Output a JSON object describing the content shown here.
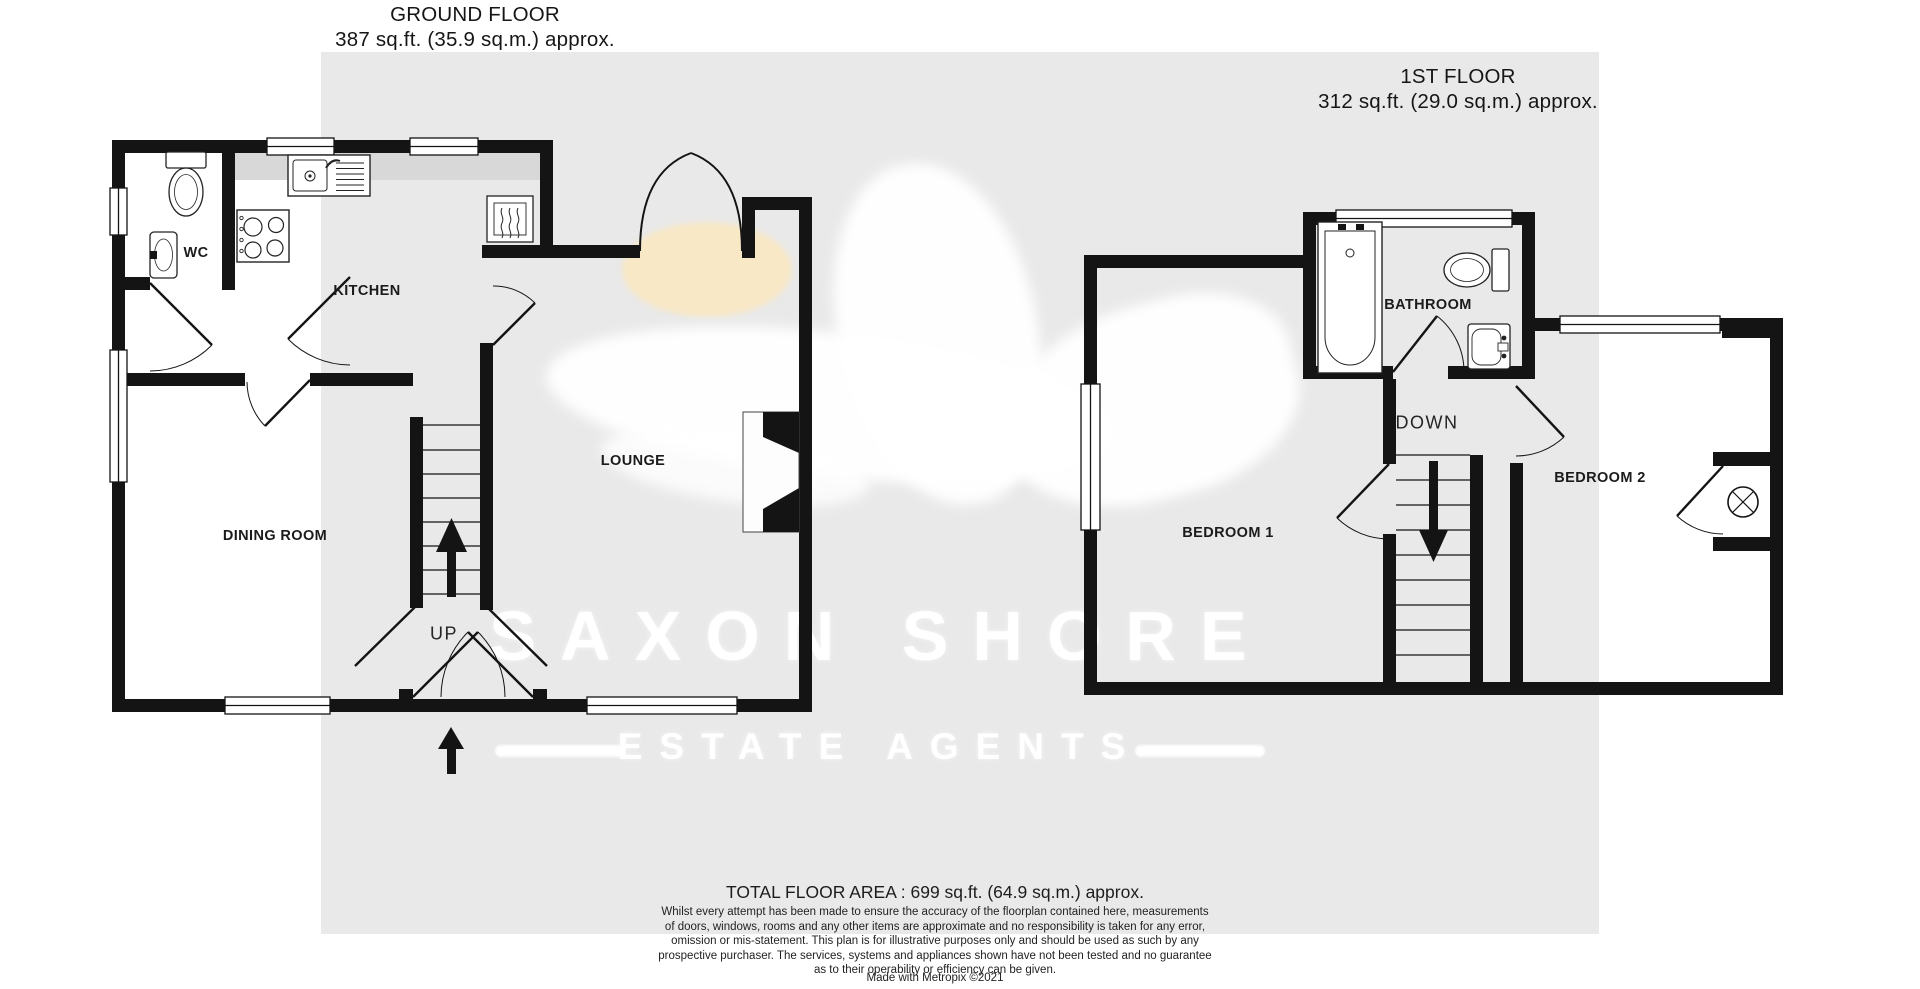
{
  "ground_floor": {
    "title": "GROUND FLOOR",
    "area_label": "387 sq.ft. (35.9 sq.m.) approx.",
    "rooms": {
      "wc": "WC",
      "kitchen": "KITCHEN",
      "dining": "DINING ROOM",
      "lounge": "LOUNGE"
    },
    "stairs_label": "UP"
  },
  "first_floor": {
    "title": "1ST FLOOR",
    "area_label": "312 sq.ft. (29.0 sq.m.) approx.",
    "rooms": {
      "bathroom": "BATHROOM",
      "bedroom1": "BEDROOM 1",
      "bedroom2": "BEDROOM 2"
    },
    "stairs_label": "DOWN"
  },
  "watermark": {
    "name_line": "SAXON SHORE",
    "tagline": "ESTATE AGENTS"
  },
  "footer": {
    "total_area": "TOTAL FLOOR AREA : 699 sq.ft. (64.9 sq.m.) approx.",
    "disclaimer_lines": [
      "Whilst every attempt has been made to ensure the accuracy of the floorplan contained here, measurements",
      "of doors, windows, rooms and any other items are approximate and no responsibility is taken for any error,",
      "omission or mis-statement. This plan is for illustrative purposes only and should be used as such by any",
      "prospective purchaser. The services, systems and appliances shown have not been tested and no guarantee",
      "as to their operability or efficiency can be given."
    ],
    "credit": "Made with Metropix ©2021"
  },
  "colors": {
    "wall": "#141414",
    "background_panel": "#e9e9e9",
    "counter": "#d8d8d8",
    "watermark": "#ffffff",
    "sun": "#f8e8c6"
  }
}
